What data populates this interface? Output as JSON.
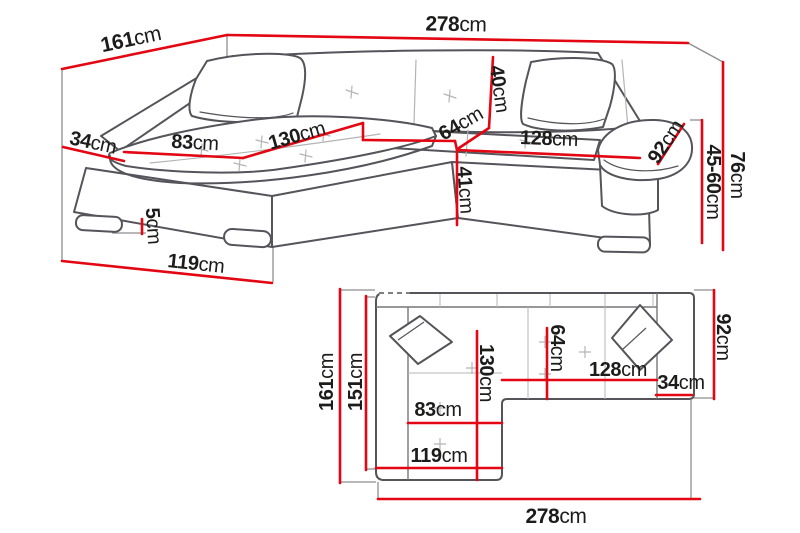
{
  "colors": {
    "dimension_red": "#e30613",
    "outline_gray": "#54545a",
    "light_gray": "#b4b4b6",
    "extension_gray": "#8e8e91",
    "text_ink": "#1c1c1a",
    "background": "#ffffff"
  },
  "perspective": {
    "labels": {
      "d161": {
        "value": "161",
        "unit": "cm"
      },
      "d278": {
        "value": "278",
        "unit": "cm"
      },
      "d40": {
        "value": "40",
        "unit": "cm"
      },
      "d64": {
        "value": "64",
        "unit": "cm"
      },
      "d128": {
        "value": "128",
        "unit": "cm"
      },
      "d92": {
        "value": "92",
        "unit": "cm"
      },
      "d34": {
        "value": "34",
        "unit": "cm"
      },
      "d83": {
        "value": "83",
        "unit": "cm"
      },
      "d130": {
        "value": "130",
        "unit": "cm"
      },
      "d41": {
        "value": "41",
        "unit": "cm"
      },
      "d5": {
        "value": "5",
        "unit": "cm"
      },
      "d119": {
        "value": "119",
        "unit": "cm"
      },
      "d76": {
        "value": "76",
        "unit": "cm"
      },
      "d45_60": {
        "value": "45-60",
        "unit": "cm"
      }
    }
  },
  "plan": {
    "labels": {
      "d161": {
        "value": "161",
        "unit": "cm"
      },
      "d151": {
        "value": "151",
        "unit": "cm"
      },
      "d130": {
        "value": "130",
        "unit": "cm"
      },
      "d64": {
        "value": "64",
        "unit": "cm"
      },
      "d92": {
        "value": "92",
        "unit": "cm"
      },
      "d83": {
        "value": "83",
        "unit": "cm"
      },
      "d119": {
        "value": "119",
        "unit": "cm"
      },
      "d128": {
        "value": "128",
        "unit": "cm"
      },
      "d34": {
        "value": "34",
        "unit": "cm"
      },
      "d278": {
        "value": "278",
        "unit": "cm"
      }
    }
  }
}
